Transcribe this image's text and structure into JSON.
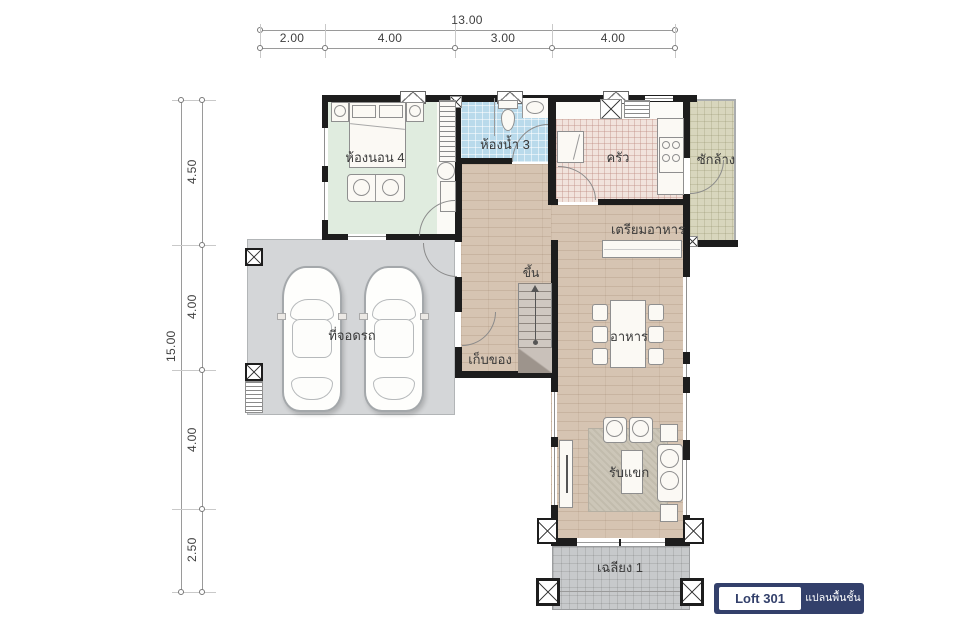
{
  "dimensions": {
    "top": {
      "total": "13.00",
      "segments": [
        "2.00",
        "4.00",
        "3.00",
        "4.00"
      ]
    },
    "left": {
      "total": "15.00",
      "segments": [
        "4.50",
        "4.00",
        "4.00",
        "2.50"
      ]
    }
  },
  "rooms": {
    "bedroom4": "ห้องนอน 4",
    "bathroom3": "ห้องน้ำ 3",
    "kitchen": "ครัว",
    "laundry": "ซักล้าง",
    "food_prep": "เตรียมอาหาร",
    "parking": "ที่จอดรถ",
    "storage": "เก็บของ",
    "stairs_up": "ขึ้น",
    "dining": "อาหาร",
    "living": "รับแขก",
    "porch": "เฉลียง 1"
  },
  "badge": {
    "model": "Loft 301",
    "caption": "แปลนพื้นชั้น 1"
  },
  "colors": {
    "badge_navy": "#33406b",
    "wall": "#1d1d1d",
    "bedroom_floor": "#e0ecdf",
    "bathroom_floor": "#b9daeb",
    "kitchen_tile": "#f1e3dc",
    "laundry_floor": "#d8d6bd",
    "wood_floor": "#d6c4b2",
    "garage_floor": "#d4d6d8",
    "porch_floor": "#c7c9cb"
  }
}
